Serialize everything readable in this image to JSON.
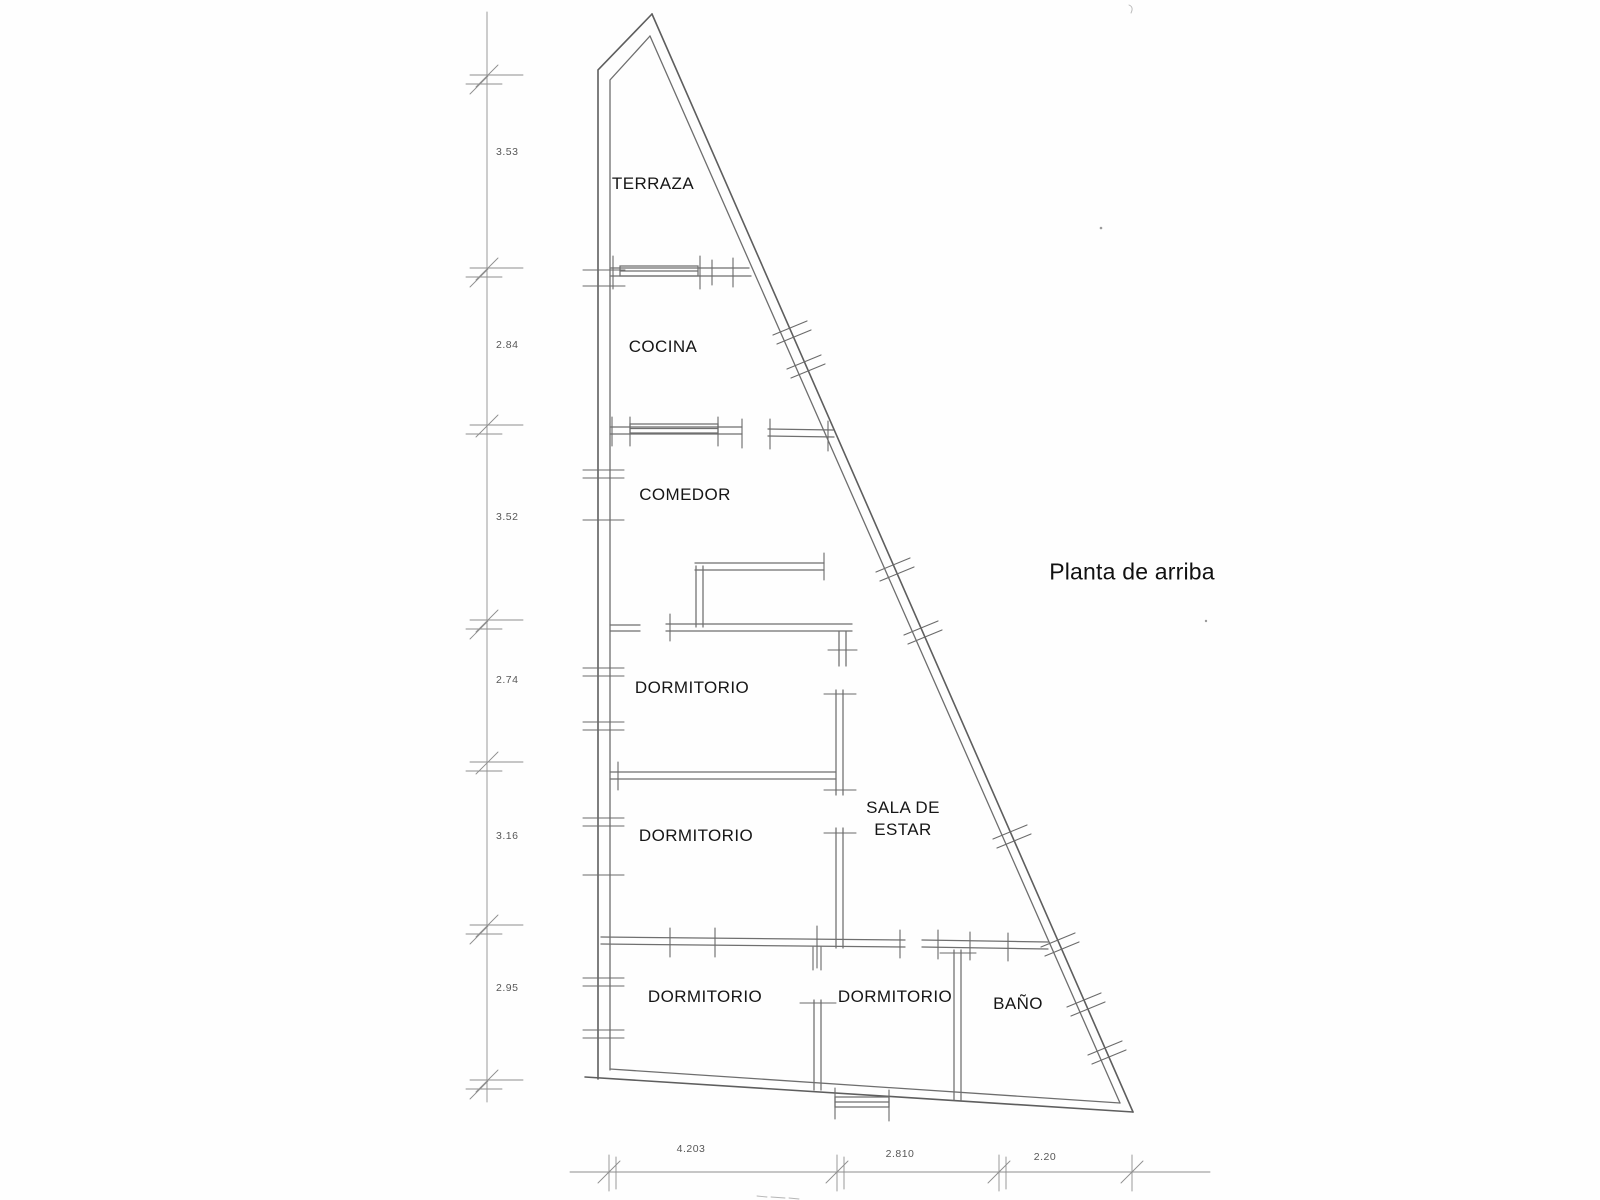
{
  "title": {
    "text": "Planta de arriba"
  },
  "rooms": [
    {
      "id": "terraza",
      "label": "TERRAZA"
    },
    {
      "id": "cocina",
      "label": "COCINA"
    },
    {
      "id": "comedor",
      "label": "COMEDOR"
    },
    {
      "id": "dormitorio-1",
      "label": "DORMITORIO"
    },
    {
      "id": "sala-de-estar",
      "label": "SALA DE ESTAR"
    },
    {
      "id": "dormitorio-2",
      "label": "DORMITORIO"
    },
    {
      "id": "dormitorio-3",
      "label": "DORMITORIO"
    },
    {
      "id": "dormitorio-4",
      "label": "DORMITORIO"
    },
    {
      "id": "bano",
      "label": "BAÑO"
    }
  ],
  "dimensions": {
    "left": [
      "3.53",
      "2.84",
      "3.52",
      "2.74",
      "3.16",
      "2.95"
    ],
    "bottom": [
      "4.203",
      "2.810",
      "2.20"
    ]
  },
  "drawing": {
    "type": "scanned-floor-plan",
    "line_color": "#6f6f6f",
    "outline_color": "#5e5e5e",
    "dimension_line_color": "#8f8f8f",
    "label_color": "#161616",
    "dimension_text_color": "#454545",
    "background_color": "#fefefe"
  }
}
